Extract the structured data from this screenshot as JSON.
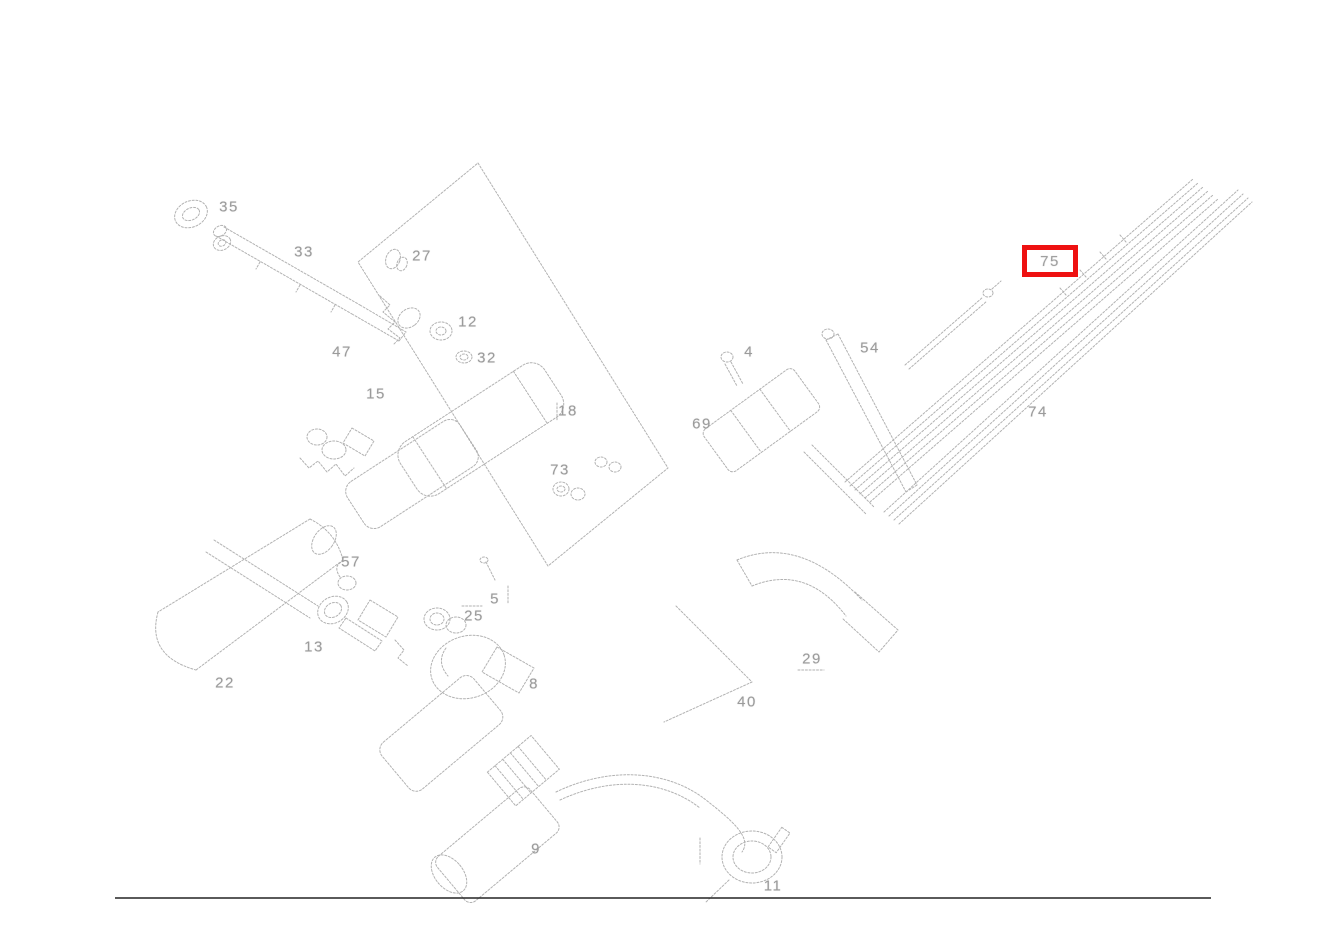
{
  "page": {
    "background": "#ffffff"
  },
  "diagram": {
    "kind": "exploded-parts-line-drawing",
    "subject": "steering column and ignition lock assembly exploded view",
    "line_color": "#b2b2b2",
    "label_color": "#9b9b9b",
    "highlight": {
      "text": "75",
      "box_color": "#ee1111",
      "x": 1022,
      "y": 245,
      "width": 56,
      "height": 32
    },
    "part_labels": [
      {
        "text": "35",
        "x": 229,
        "y": 207
      },
      {
        "text": "33",
        "x": 304,
        "y": 252
      },
      {
        "text": "27",
        "x": 422,
        "y": 256
      },
      {
        "text": "12",
        "x": 468,
        "y": 322
      },
      {
        "text": "32",
        "x": 487,
        "y": 358
      },
      {
        "text": "47",
        "x": 342,
        "y": 352
      },
      {
        "text": "15",
        "x": 376,
        "y": 394
      },
      {
        "text": "18",
        "x": 568,
        "y": 411
      },
      {
        "text": "73",
        "x": 560,
        "y": 470
      },
      {
        "text": "4",
        "x": 749,
        "y": 352
      },
      {
        "text": "54",
        "x": 870,
        "y": 348
      },
      {
        "text": "69",
        "x": 702,
        "y": 424
      },
      {
        "text": "5",
        "x": 495,
        "y": 599
      },
      {
        "text": "57",
        "x": 351,
        "y": 562
      },
      {
        "text": "25",
        "x": 474,
        "y": 616
      },
      {
        "text": "13",
        "x": 314,
        "y": 647
      },
      {
        "text": "22",
        "x": 225,
        "y": 683
      },
      {
        "text": "8",
        "x": 534,
        "y": 684
      },
      {
        "text": "29",
        "x": 812,
        "y": 659
      },
      {
        "text": "40",
        "x": 747,
        "y": 702
      },
      {
        "text": "9",
        "x": 536,
        "y": 849
      },
      {
        "text": "11",
        "x": 773,
        "y": 886
      },
      {
        "text": "74",
        "x": 1038,
        "y": 412
      }
    ],
    "bottom_rule": {
      "x1": 115,
      "y1": 898,
      "x2": 1211,
      "y2": 898,
      "color": "#242424"
    }
  }
}
